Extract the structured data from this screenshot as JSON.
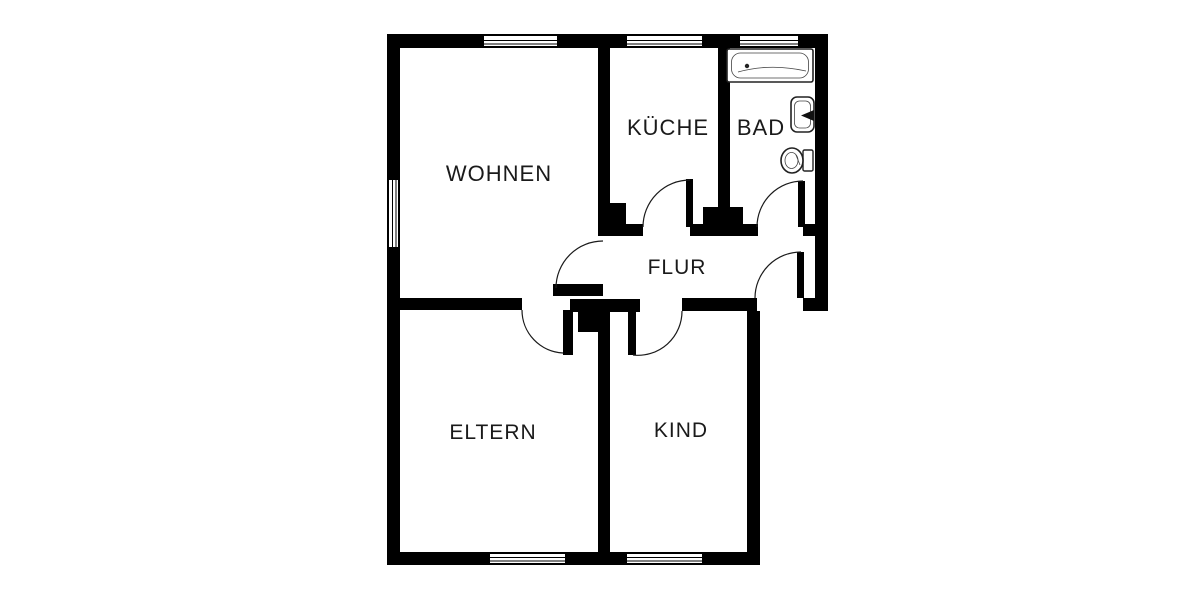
{
  "page": {
    "type": "floor-plan",
    "background_color": "#ffffff"
  },
  "colors": {
    "wall": "#000000",
    "text": "#1a1a1a",
    "fixture_outline": "#222222"
  },
  "floorplan": {
    "rooms": {
      "wohnen": {
        "label": "WOHNEN"
      },
      "kueche": {
        "label": "KÜCHE"
      },
      "bad": {
        "label": "BAD"
      },
      "flur": {
        "label": "FLUR"
      },
      "eltern": {
        "label": "ELTERN"
      },
      "kind": {
        "label": "KIND"
      }
    },
    "fixtures": [
      {
        "icon": "bathtub-icon",
        "room": "BAD"
      },
      {
        "icon": "sink-icon",
        "room": "BAD"
      },
      {
        "icon": "toilet-icon",
        "room": "BAD"
      }
    ],
    "doors": [
      {
        "name": "wohnen-door",
        "connects": "WOHNEN-FLUR"
      },
      {
        "name": "kueche-door",
        "connects": "KÜCHE-FLUR"
      },
      {
        "name": "bad-door",
        "connects": "BAD-FLUR"
      },
      {
        "name": "entry-door",
        "connects": "FLUR-outside"
      },
      {
        "name": "eltern-door",
        "connects": "ELTERN-FLUR"
      },
      {
        "name": "kind-door",
        "connects": "KIND-FLUR"
      }
    ],
    "windows_count": 6
  }
}
